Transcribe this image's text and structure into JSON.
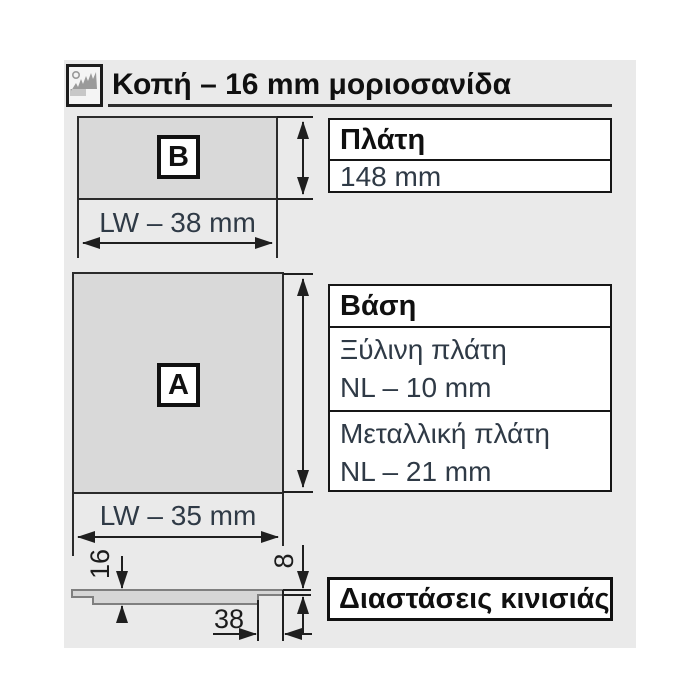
{
  "header": {
    "title": "Κοπή – 16 mm μοριοσανίδα",
    "icon": "circular-saw"
  },
  "part_b": {
    "badge": "B",
    "width_label": "LW – 38 mm"
  },
  "back_table": {
    "header": "Πλάτη",
    "value": "148 mm"
  },
  "part_a": {
    "badge": "A",
    "width_label": "LW – 35 mm"
  },
  "base_table": {
    "header": "Βάση",
    "rows": [
      {
        "line1": "Ξύλινη πλάτη",
        "line2": "NL – 10 mm"
      },
      {
        "line1": "Μεταλλική πλάτη",
        "line2": "NL – 21 mm"
      }
    ]
  },
  "profile": {
    "thickness_mm": "16",
    "lip_mm": "8",
    "notch_mm": "38"
  },
  "footer": {
    "label": "Διαστάσεις κινισιάς"
  },
  "colors": {
    "panel_bg": "#eaeaea",
    "part_fill": "#d9d9d9",
    "line": "#1f1f1f",
    "value_text": "#2f3a46",
    "profile_stroke": "#7f7f7f"
  }
}
